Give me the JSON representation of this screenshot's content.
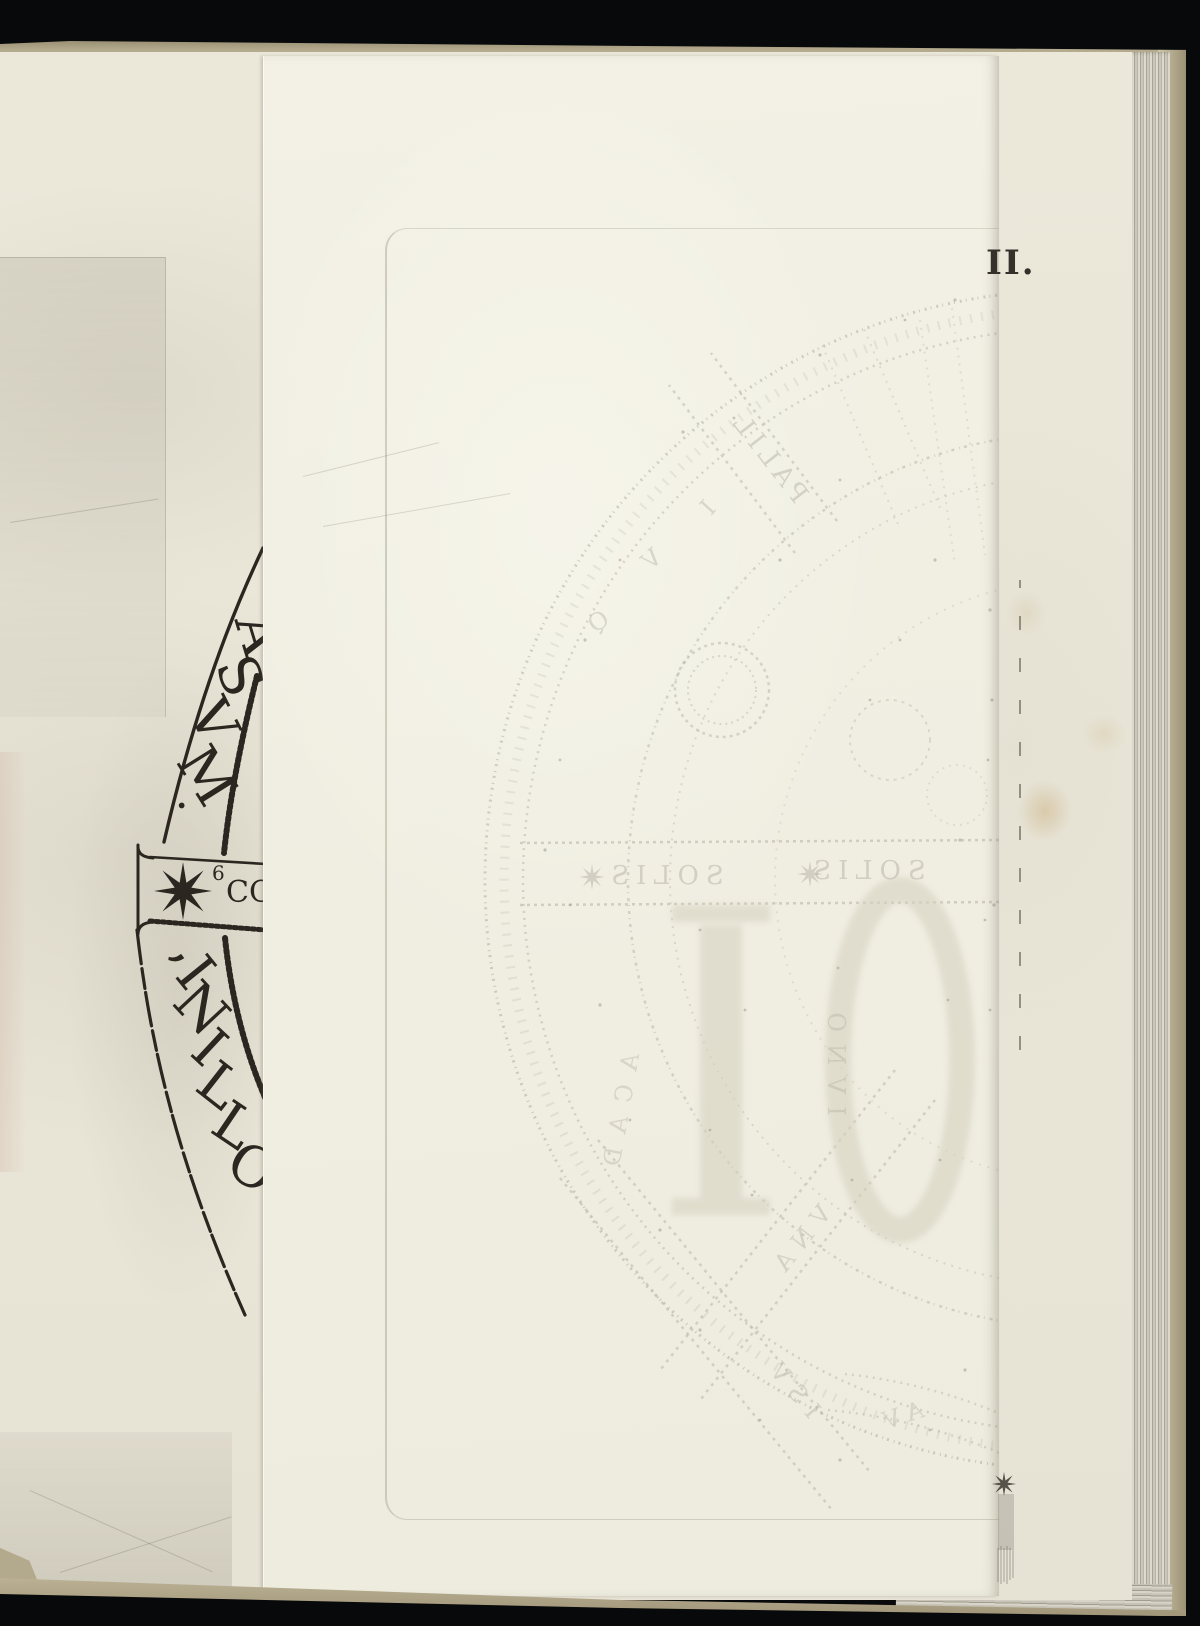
{
  "scan": {
    "backdrop_color": "#08090b",
    "book_edge_color": "#ab9f80",
    "page_color": "#eae6d8",
    "interleaf_color": "#f2f0e3",
    "ink_color": "#2b2720",
    "setoff_ink_color": "#8e897a"
  },
  "right_page": {
    "plate_number": "II."
  },
  "left_plate": {
    "inscription": "OLLINI, · MVSA",
    "glyphs": [
      "O",
      "L",
      "L",
      "I",
      "N",
      "I",
      ",",
      "·",
      "M",
      "V",
      "S",
      "A"
    ],
    "band": {
      "numeral": "6",
      "label_fragment": "CO",
      "icon": "eight-point-star"
    }
  },
  "interleaf_setoff": {
    "fragments": {
      "spoke": "PALIL",
      "band_left": "SOLIS",
      "band_right": "SOLIS",
      "between_numerals": "IVNO",
      "cross_upper": "VNA",
      "cross_lower": "ISV",
      "arc_bottom": "AV",
      "arc_left": "ACAD",
      "ring": [
        "Q",
        "V",
        "I"
      ],
      "large_numerals": "IO"
    }
  }
}
